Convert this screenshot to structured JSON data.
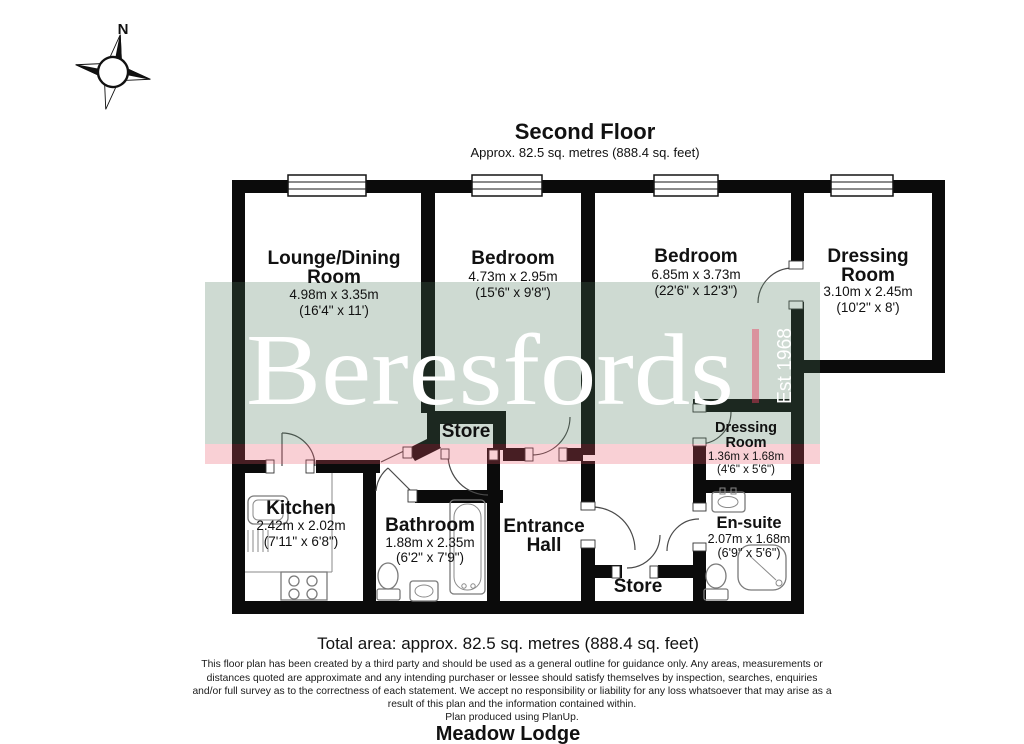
{
  "title": {
    "heading": "Second Floor",
    "subheading": "Approx. 82.5 sq. metres (888.4 sq. feet)"
  },
  "compass": {
    "north_label": "N"
  },
  "watermark": {
    "brand": "Beresfords",
    "established": "Est 1968"
  },
  "rooms": {
    "lounge": {
      "name_line1": "Lounge/Dining",
      "name_line2": "Room",
      "metric": "4.98m x 3.35m",
      "imperial": "(16'4\" x 11')"
    },
    "bedroom1": {
      "name": "Bedroom",
      "metric": "4.73m x 2.95m",
      "imperial": "(15'6\" x 9'8\")"
    },
    "bedroom2": {
      "name": "Bedroom",
      "metric": "6.85m x 3.73m",
      "imperial": "(22'6\" x 12'3\")"
    },
    "dressing_large": {
      "name_line1": "Dressing",
      "name_line2": "Room",
      "metric": "3.10m x 2.45m",
      "imperial": "(10'2\" x 8')"
    },
    "store_upper": {
      "name": "Store"
    },
    "kitchen": {
      "name": "Kitchen",
      "metric": "2.42m x 2.02m",
      "imperial": "(7'11\" x 6'8\")"
    },
    "bathroom": {
      "name": "Bathroom",
      "metric": "1.88m x 2.35m",
      "imperial": "(6'2\" x 7'9\")"
    },
    "entrance_hall": {
      "name_line1": "Entrance",
      "name_line2": "Hall"
    },
    "store_lower": {
      "name": "Store"
    },
    "dressing_small": {
      "name_line1": "Dressing",
      "name_line2": "Room",
      "metric": "1.36m x 1.68m",
      "imperial": "(4'6\" x 5'6\")"
    },
    "ensuite": {
      "name": "En-suite",
      "metric": "2.07m x 1.68m",
      "imperial": "(6'9\" x 5'6\")"
    }
  },
  "footer": {
    "total_area": "Total area: approx. 82.5 sq. metres (888.4 sq. feet)",
    "disclaimer_lines": [
      "This floor plan has been created by a third party and should be used as a general outline for guidance only. Any areas, measurements or",
      "distances quoted are approximate and any intending purchaser or lessee should satisfy themselves by inspection, searches, enquiries",
      "and/or full survey as to the correctness of each statement. We accept no responsibility or liability for any loss whatsoever that may arise as a",
      "result of this plan and the information contained within.",
      "Plan produced using PlanUp."
    ],
    "property_name": "Meadow Lodge"
  },
  "colors": {
    "wall": "#0b0b0b",
    "watermark_green": "rgba(74,118,89,0.27)",
    "watermark_pink_band": "rgba(232,80,100,0.27)",
    "watermark_pink_bar": "rgba(232,60,95,0.45)",
    "watermark_text": "#ffffff"
  }
}
